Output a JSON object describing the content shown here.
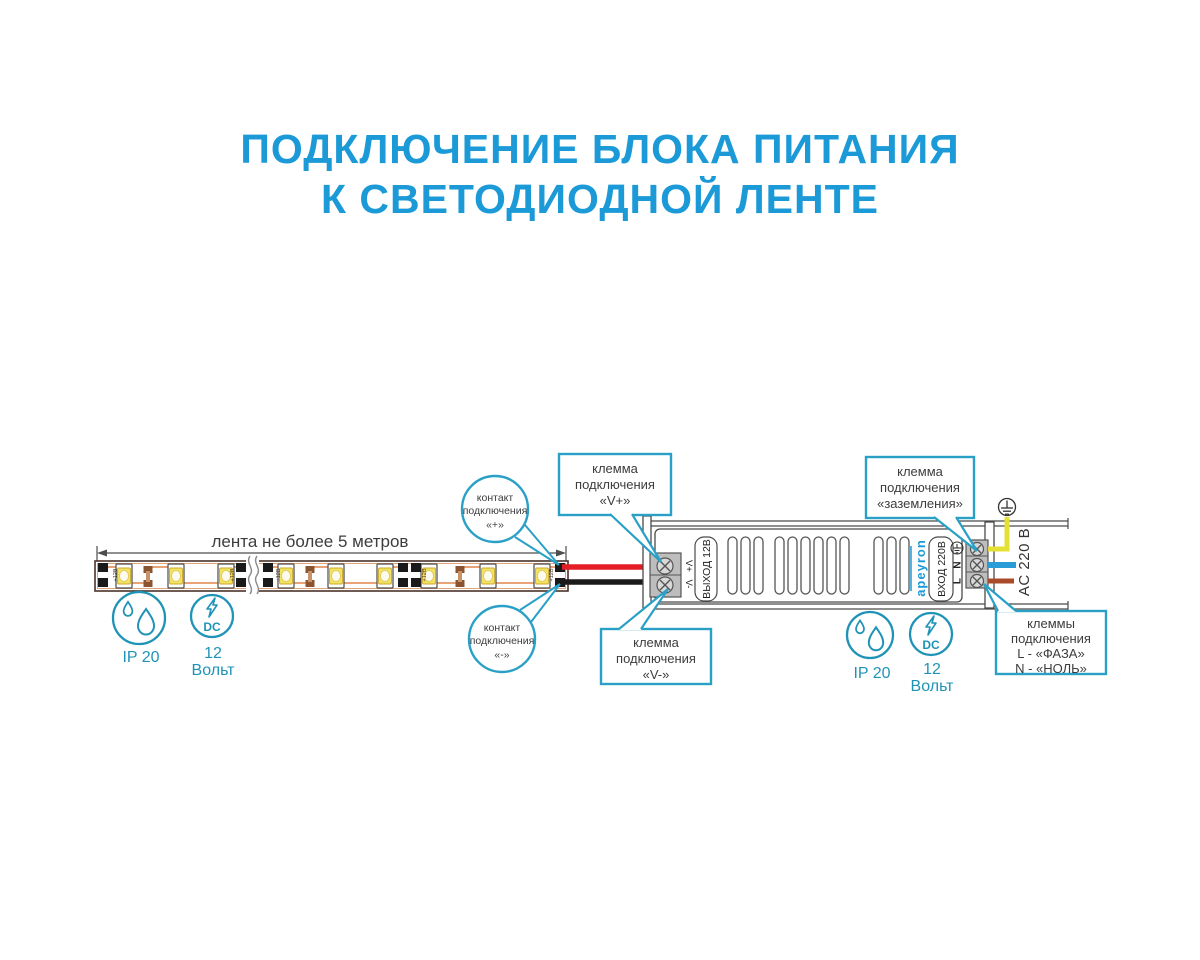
{
  "title": {
    "line1": "ПОДКЛЮЧЕНИЕ БЛОКА ПИТАНИЯ",
    "line2": "К СВЕТОДИОДНОЙ ЛЕНТЕ"
  },
  "strip": {
    "dimension_label": "лента не более 5 метров",
    "pad_marking": "+12В"
  },
  "callouts": {
    "contact_plus": {
      "lines": [
        "контакт",
        "подключения",
        "«+»"
      ]
    },
    "contact_minus": {
      "lines": [
        "контакт",
        "подключения",
        "«-»"
      ]
    },
    "terminal_v_plus": {
      "lines": [
        "клемма",
        "подключения",
        "«V+»"
      ]
    },
    "terminal_v_minus": {
      "lines": [
        "клемма",
        "подключения",
        "«V-»"
      ]
    },
    "terminal_ground": {
      "lines": [
        "клемма",
        "подключения",
        "«заземления»"
      ]
    },
    "terminal_line_neutral": {
      "lines": [
        "клеммы",
        "подключения",
        "L - «ФАЗА»",
        "N - «НОЛЬ»"
      ]
    }
  },
  "psu": {
    "output_label": "ВЫХОД 12В",
    "input_label": "ВХОД 220В",
    "brand": "apeyron",
    "v_plus": "V+",
    "v_minus": "V-",
    "neutral": "N",
    "line": "L",
    "ac_label": "AC 220 В"
  },
  "badges": {
    "ip_rating": "IP 20",
    "dc_label": "DC",
    "voltage_value": "12",
    "voltage_unit": "Вольт"
  },
  "colors": {
    "accent_blue": "#1b9ad7",
    "callout_teal": "#2aa0c6",
    "badge_teal": "#1f93b6",
    "wire_red": "#e31e24",
    "wire_black": "#1a1a1a",
    "wire_yellow": "#e4e134",
    "wire_blue": "#2a9dd8",
    "wire_brown": "#aa4a28"
  }
}
